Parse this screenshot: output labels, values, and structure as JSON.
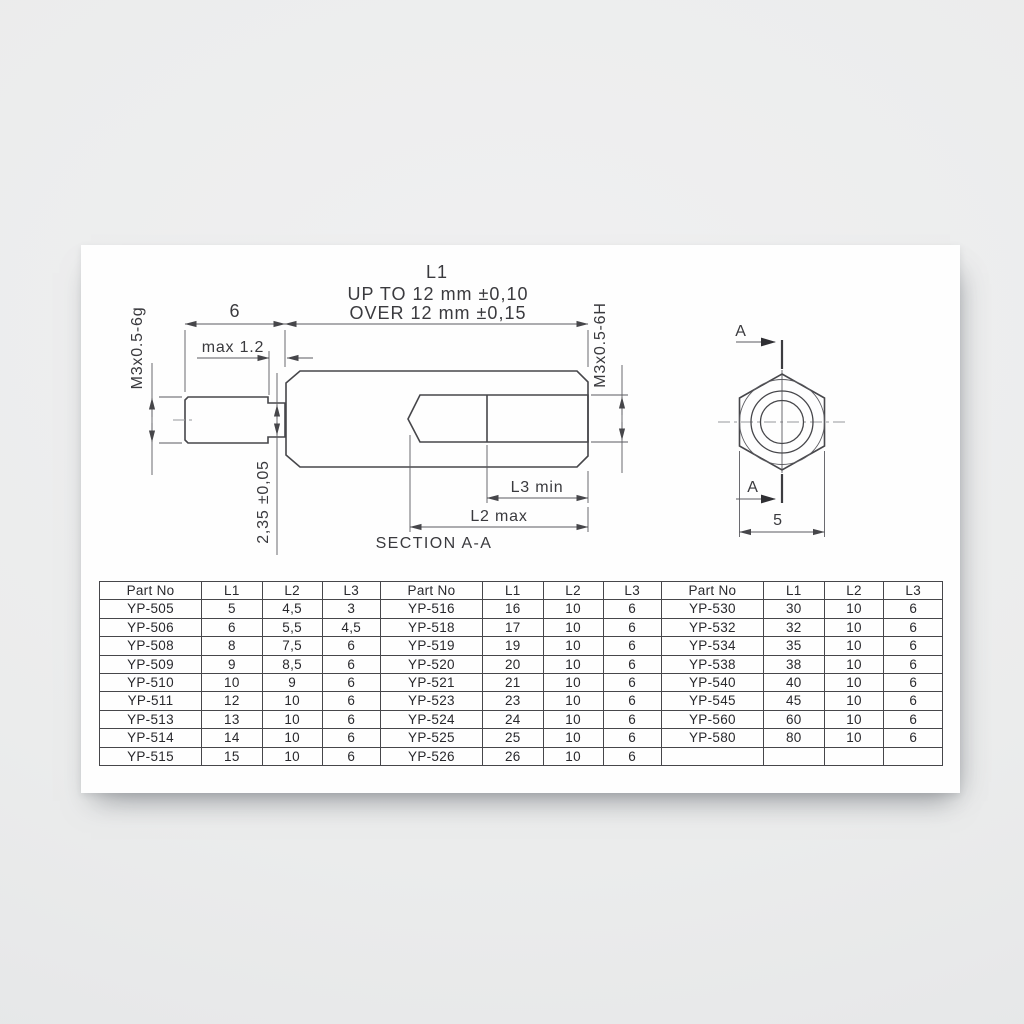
{
  "drawing": {
    "l1_label": "L1",
    "tolerance_line1": "UP TO 12 mm  ±0,10",
    "tolerance_line2": "OVER 12 mm  ±0,15",
    "stud_length_dim": "6",
    "undercut_width_dim": "max 1.2",
    "male_thread_label": "M3x0.5-6g",
    "female_thread_label": "M3x0.5-6H",
    "undercut_dia_dim": "2,35 ±0,05",
    "l3_dim_label": "L3 min",
    "l2_dim_label": "L2 max",
    "section_label": "SECTION A-A",
    "section_arrow_label": "A",
    "across_flats_dim": "5"
  },
  "table": {
    "headers": [
      "Part No",
      "L1",
      "L2",
      "L3"
    ],
    "groups": [
      {
        "rows": [
          [
            "YP-505",
            "5",
            "4,5",
            "3"
          ],
          [
            "YP-506",
            "6",
            "5,5",
            "4,5"
          ],
          [
            "YP-508",
            "8",
            "7,5",
            "6"
          ],
          [
            "YP-509",
            "9",
            "8,5",
            "6"
          ],
          [
            "YP-510",
            "10",
            "9",
            "6"
          ],
          [
            "YP-511",
            "12",
            "10",
            "6"
          ],
          [
            "YP-513",
            "13",
            "10",
            "6"
          ],
          [
            "YP-514",
            "14",
            "10",
            "6"
          ],
          [
            "YP-515",
            "15",
            "10",
            "6"
          ]
        ]
      },
      {
        "rows": [
          [
            "YP-516",
            "16",
            "10",
            "6"
          ],
          [
            "YP-518",
            "17",
            "10",
            "6"
          ],
          [
            "YP-519",
            "19",
            "10",
            "6"
          ],
          [
            "YP-520",
            "20",
            "10",
            "6"
          ],
          [
            "YP-521",
            "21",
            "10",
            "6"
          ],
          [
            "YP-523",
            "23",
            "10",
            "6"
          ],
          [
            "YP-524",
            "24",
            "10",
            "6"
          ],
          [
            "YP-525",
            "25",
            "10",
            "6"
          ],
          [
            "YP-526",
            "26",
            "10",
            "6"
          ]
        ]
      },
      {
        "rows": [
          [
            "YP-530",
            "30",
            "10",
            "6"
          ],
          [
            "YP-532",
            "32",
            "10",
            "6"
          ],
          [
            "YP-534",
            "35",
            "10",
            "6"
          ],
          [
            "YP-538",
            "38",
            "10",
            "6"
          ],
          [
            "YP-540",
            "40",
            "10",
            "6"
          ],
          [
            "YP-545",
            "45",
            "10",
            "6"
          ],
          [
            "YP-560",
            "60",
            "10",
            "6"
          ],
          [
            "YP-580",
            "80",
            "10",
            "6"
          ],
          [
            "",
            "",
            "",
            ""
          ]
        ]
      }
    ]
  },
  "colors": {
    "line": "#46464a",
    "text": "#2b2b2e",
    "paper": "#fefefe",
    "page_background": "#eaebec"
  }
}
